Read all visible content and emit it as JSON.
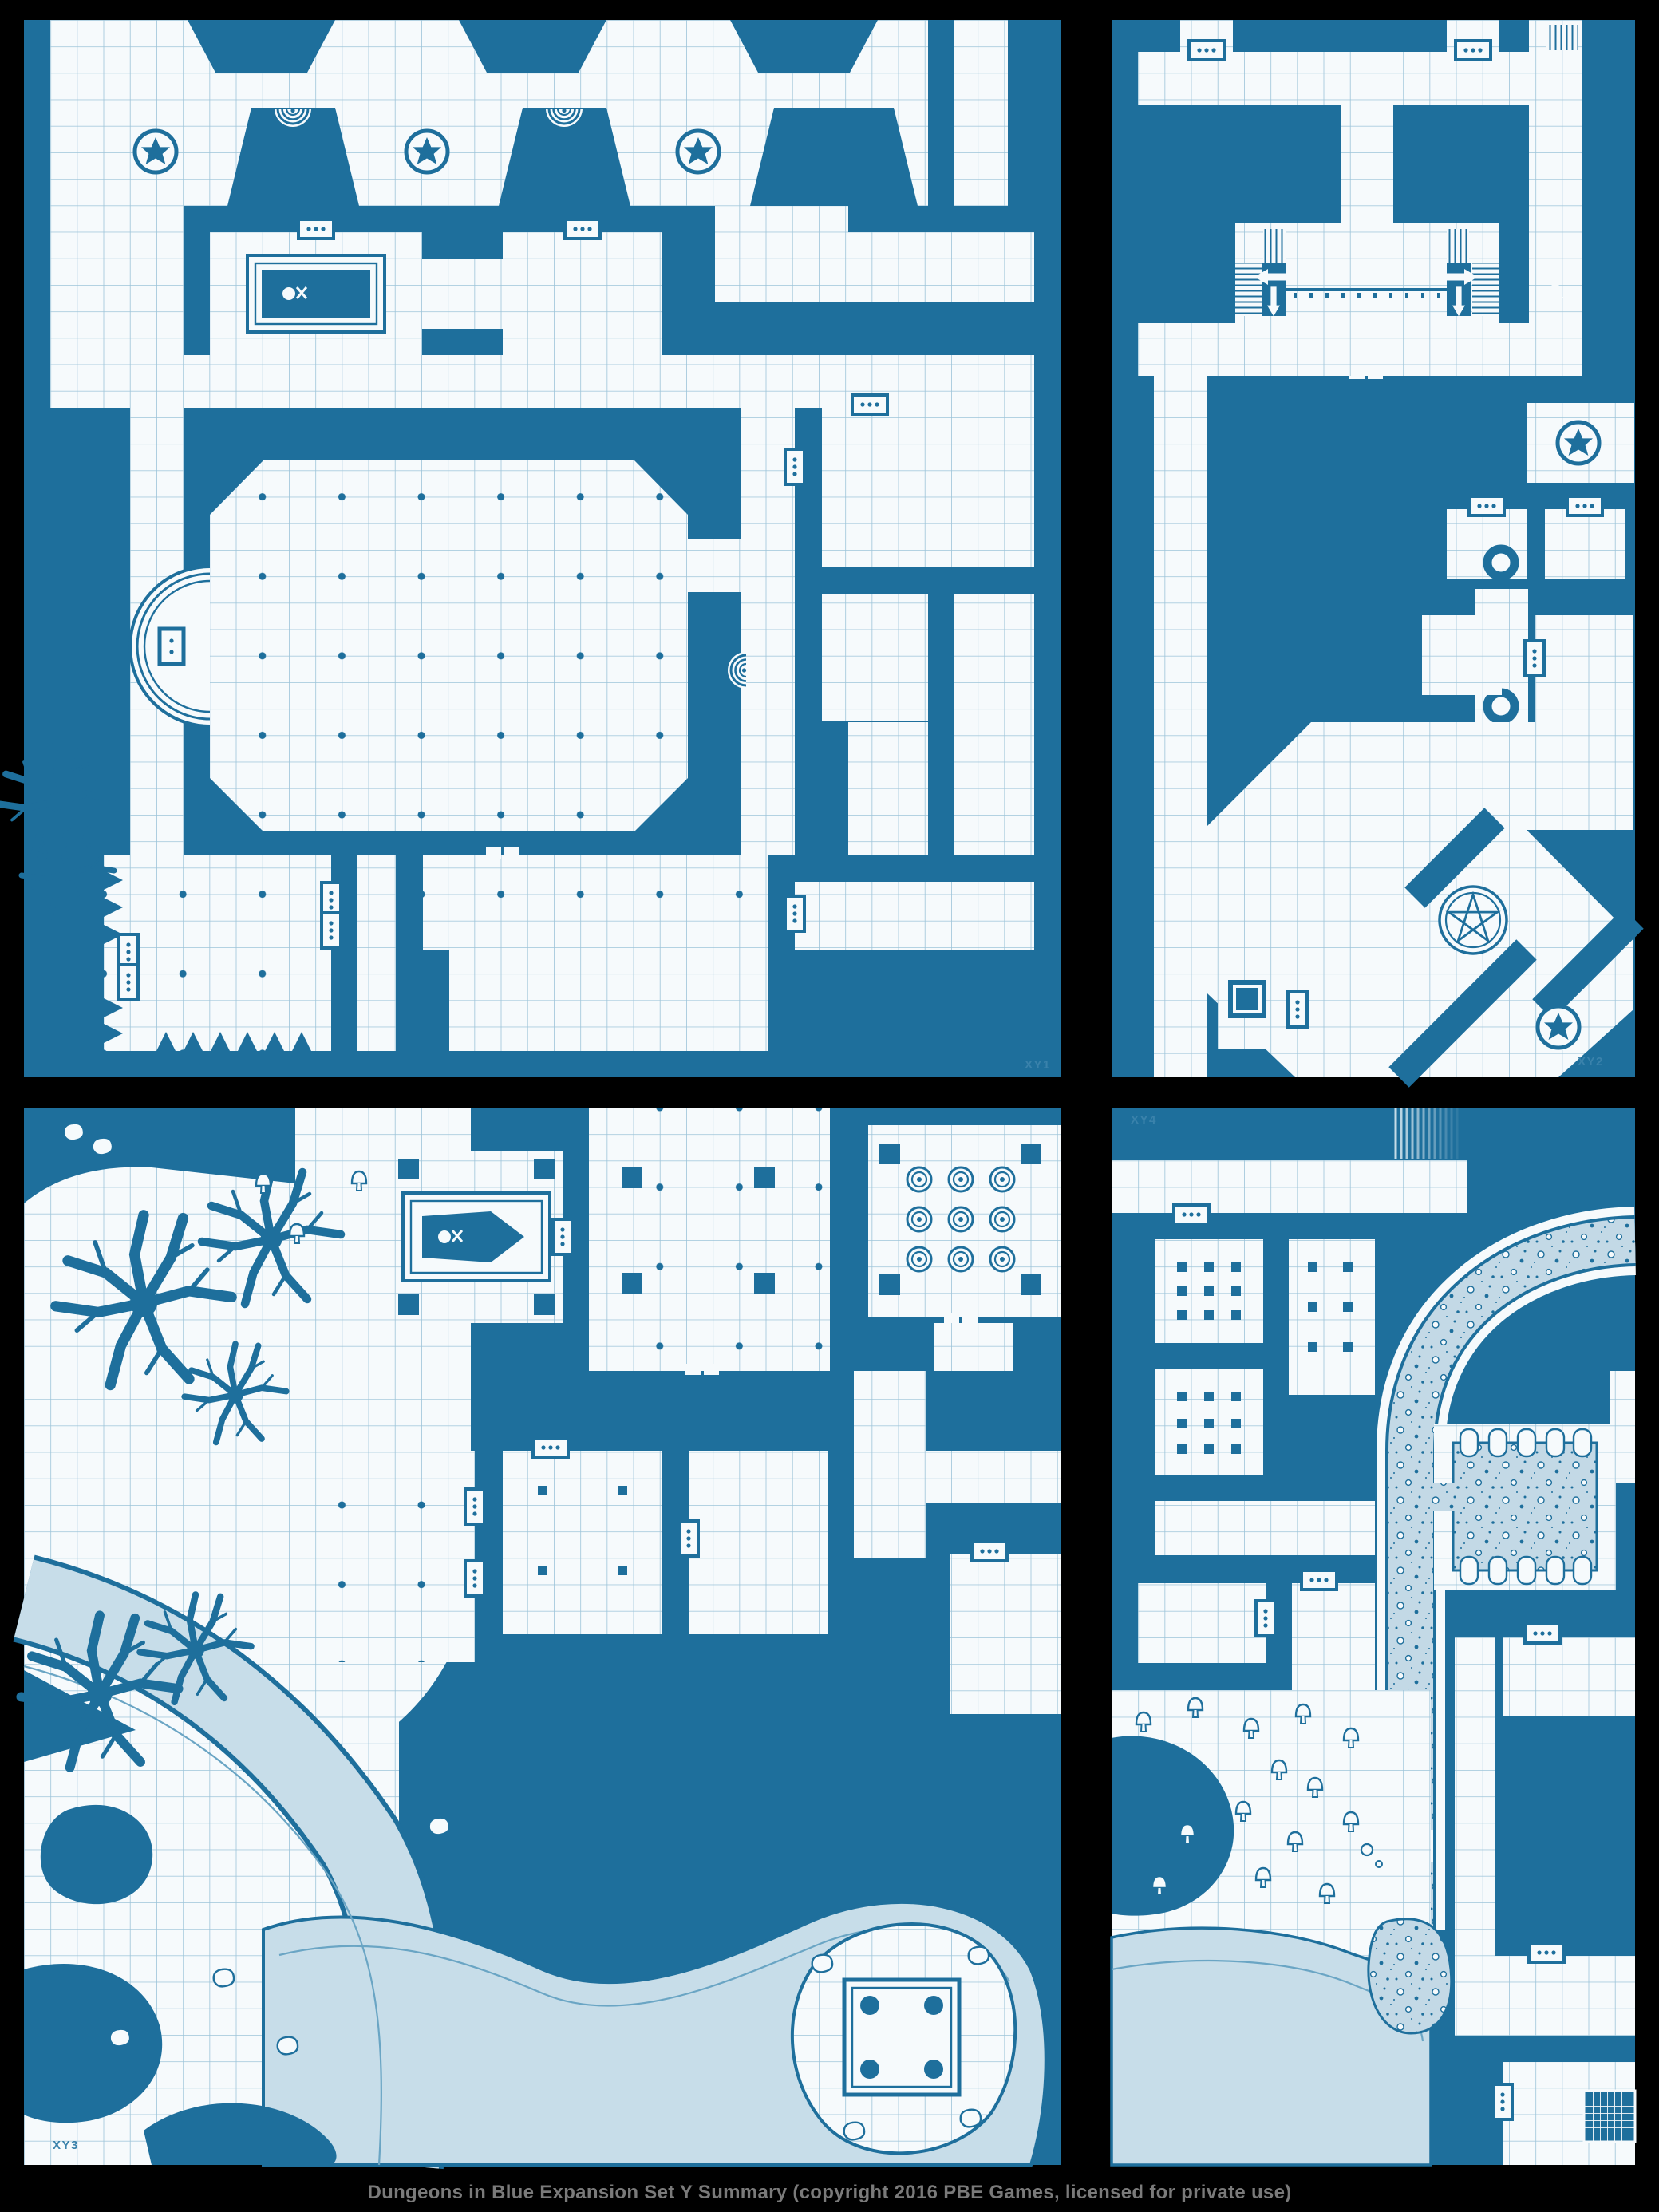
{
  "caption": {
    "text": "Dungeons in Blue Expansion Set Y Summary (copyright 2016 PBE Games, licensed for private use)"
  },
  "palette": {
    "page_background": "#000000",
    "wall": "#1e6f9c",
    "floor": "#f6fafc",
    "grid_line": "#9cc4d9",
    "water": "#c7dde9",
    "rubble": "#c3d9e6",
    "tile_label": "#3a82ab",
    "caption_text": "#7a7a7a"
  },
  "tiles": {
    "xy1": {
      "label": "XY1",
      "label_position": "bottom-right",
      "features": [
        "star-circle-icon",
        "spiral-stair-icon",
        "sarcophagus-icon",
        "apse-altar-icon",
        "great-hall",
        "spiked-corridor",
        "portcullis-door-icon",
        "dead-tree-icon",
        "pillar-dots"
      ]
    },
    "xy2": {
      "label": "XY2",
      "label_position": "bottom-right",
      "features": [
        "staircase-stripes",
        "direction-arrow-icon",
        "ledge-rail",
        "well-icon",
        "portcullis-door-icon",
        "pentagram-icon",
        "star-circle-icon",
        "diagonal-corridors",
        "chest-box-icon"
      ]
    },
    "xy3": {
      "label": "XY3",
      "label_position": "bottom-left",
      "features": [
        "river",
        "lake",
        "island-altar-icon",
        "coffin-icon",
        "dead-tree-icon",
        "mushroom-icon",
        "rock-icon",
        "ring-circle-array",
        "pillar-dots",
        "portcullis-door-icon"
      ]
    },
    "xy4": {
      "label": "XY4",
      "label_position": "top-left",
      "features": [
        "rubble-road",
        "colonnade-pillars",
        "pillar-dot-rooms",
        "mushroom-garden",
        "water-pool",
        "grate-pit",
        "fading-stair",
        "portcullis-door-icon"
      ]
    }
  }
}
